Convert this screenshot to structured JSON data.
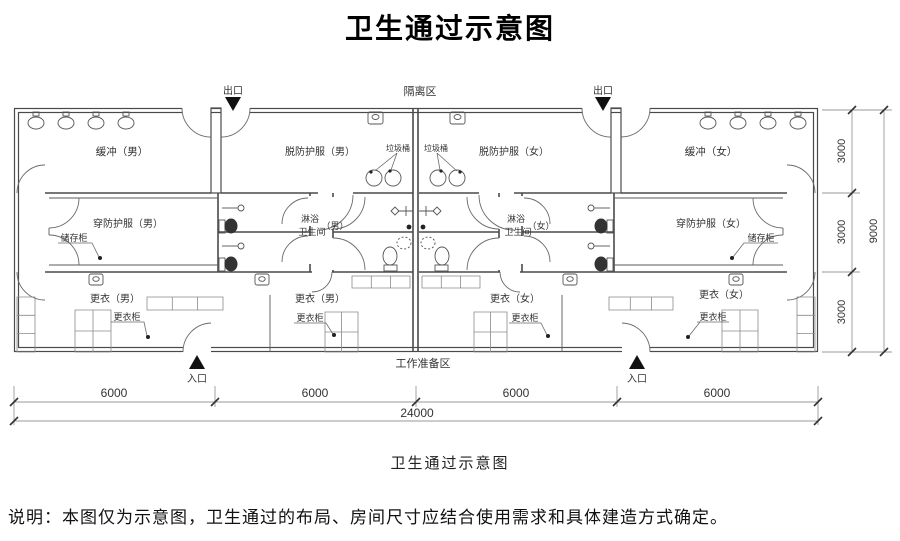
{
  "page": {
    "title": "卫生通过示意图",
    "caption": "卫生通过示意图",
    "note": "说明：本图仅为示意图，卫生通过的布局、房间尺寸应结合使用需求和具体建造方式确定。"
  },
  "zones": {
    "isolation": "隔离区",
    "work_prep": "工作准备区"
  },
  "doors": {
    "exit": "出口",
    "entrance": "入口"
  },
  "rooms": {
    "buffer_male": "缓冲（男）",
    "buffer_female": "缓冲（女）",
    "doff_ppe_male": "脱防护服（男）",
    "doff_ppe_female": "脱防护服（女）",
    "don_ppe_male": "穿防护服（男）",
    "don_ppe_female": "穿防护服（女）",
    "shower": "淋浴",
    "toilet": "卫生间",
    "male_suffix": "（男）",
    "female_suffix": "（女）",
    "change_male": "更衣（男）",
    "change_female": "更衣（女）"
  },
  "fixtures": {
    "storage_cabinet": "储存柜",
    "trash_bin": "垃圾桶",
    "locker": "更衣柜"
  },
  "dimensions": {
    "bottom_segments": [
      "6000",
      "6000",
      "6000",
      "6000"
    ],
    "bottom_total": "24000",
    "right_segments": [
      "3000",
      "3000",
      "3000"
    ],
    "right_total": "9000"
  }
}
